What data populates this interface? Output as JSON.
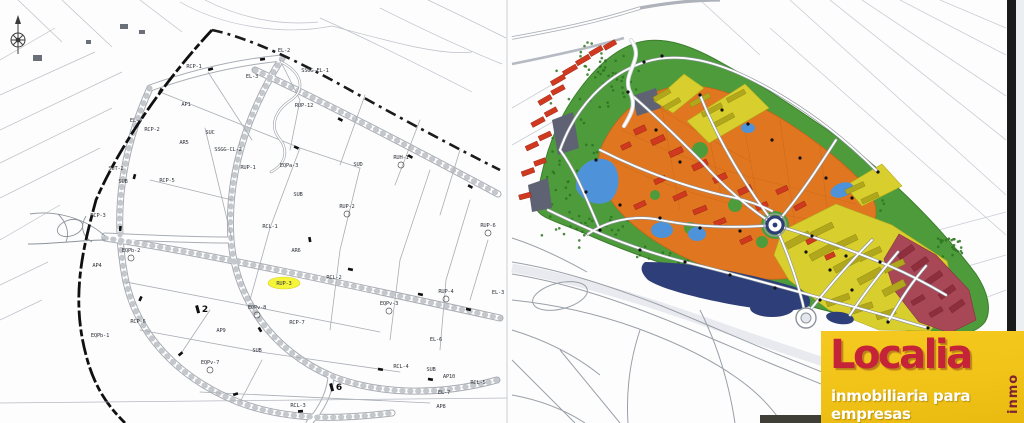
{
  "page": {
    "description": "Scanned urban-planning document: black & white cadastral zoning plan (left) and colored development masterplan (right) with Localia real-estate watermark",
    "width_px": 1024,
    "height_px": 423
  },
  "left_plan": {
    "title": "B/W cadastral zoning plan",
    "highlight_color": "#f4f43a",
    "highlighted_parcel": "RUP-3",
    "labels": [
      {
        "text": "RCP-1",
        "x": 194,
        "y": 68
      },
      {
        "text": "EL-2",
        "x": 284,
        "y": 52
      },
      {
        "text": "SSGG-EL-1",
        "x": 315,
        "y": 72
      },
      {
        "text": "EL-3",
        "x": 252,
        "y": 78
      },
      {
        "text": "AP1",
        "x": 186,
        "y": 106
      },
      {
        "text": "RUP-12",
        "x": 304,
        "y": 107
      },
      {
        "text": "EL-4",
        "x": 136,
        "y": 122
      },
      {
        "text": "RCP-2",
        "x": 152,
        "y": 131
      },
      {
        "text": "SUC",
        "x": 210,
        "y": 134
      },
      {
        "text": "AR5",
        "x": 184,
        "y": 144
      },
      {
        "text": "SSGG-CL-2",
        "x": 228,
        "y": 151
      },
      {
        "text": "SUT-2",
        "x": 116,
        "y": 170
      },
      {
        "text": "SUB",
        "x": 123,
        "y": 183
      },
      {
        "text": "RCP-5",
        "x": 167,
        "y": 182
      },
      {
        "text": "RUP-1",
        "x": 248,
        "y": 169
      },
      {
        "text": "EQPa-3",
        "x": 289,
        "y": 167
      },
      {
        "text": "SUD",
        "x": 358,
        "y": 166
      },
      {
        "text": "RUH-1",
        "x": 401,
        "y": 159,
        "circle": true
      },
      {
        "text": "SUB",
        "x": 298,
        "y": 196
      },
      {
        "text": "RUP-2",
        "x": 347,
        "y": 208,
        "circle": true
      },
      {
        "text": "RCP-3",
        "x": 98,
        "y": 217
      },
      {
        "text": "RCL-1",
        "x": 270,
        "y": 228
      },
      {
        "text": "RUP-6",
        "x": 488,
        "y": 227,
        "circle": true
      },
      {
        "text": "AR6",
        "x": 296,
        "y": 252
      },
      {
        "text": "EQPb-2",
        "x": 131,
        "y": 252,
        "circle": true
      },
      {
        "text": "AP4",
        "x": 97,
        "y": 267
      },
      {
        "text": "RUP-3",
        "x": 284,
        "y": 285,
        "hl": true
      },
      {
        "text": "RCL-2",
        "x": 334,
        "y": 279
      },
      {
        "text": "EL-3",
        "x": 498,
        "y": 294
      },
      {
        "text": "RUP-4",
        "x": 446,
        "y": 293,
        "circle": true
      },
      {
        "text": "EQPv-3",
        "x": 389,
        "y": 305,
        "circle": true
      },
      {
        "text": "EQPv-8",
        "x": 257,
        "y": 309,
        "circle": true
      },
      {
        "text": "RCP-7",
        "x": 297,
        "y": 324
      },
      {
        "text": "RCP-6",
        "x": 138,
        "y": 323
      },
      {
        "text": "AP9",
        "x": 221,
        "y": 332
      },
      {
        "text": "EQPb-1",
        "x": 100,
        "y": 337
      },
      {
        "text": "EL-6",
        "x": 436,
        "y": 341
      },
      {
        "text": "SUB",
        "x": 257,
        "y": 352
      },
      {
        "text": "EQPv-7",
        "x": 210,
        "y": 364,
        "circle": true
      },
      {
        "text": "RCL-4",
        "x": 401,
        "y": 368
      },
      {
        "text": "SUB",
        "x": 431,
        "y": 371
      },
      {
        "text": "AP10",
        "x": 449,
        "y": 378
      },
      {
        "text": "RCL-5",
        "x": 478,
        "y": 384
      },
      {
        "text": "EL-7",
        "x": 444,
        "y": 394
      },
      {
        "text": "RCL-3",
        "x": 298,
        "y": 407
      },
      {
        "text": "AP8",
        "x": 441,
        "y": 408
      }
    ],
    "road_markers": [
      {
        "text": "2",
        "x": 203,
        "y": 312
      },
      {
        "text": "6",
        "x": 337,
        "y": 390
      }
    ]
  },
  "right_plan": {
    "title": "Colored development masterplan",
    "colors": {
      "parkland_green": "#4e9b3c",
      "tree_green": "#2c741f",
      "residential_orange": "#e0761f",
      "building_red": "#d0391f",
      "mixed_yellow": "#d8cf2e",
      "terrace_yellow_dark": "#b1a71c",
      "strip_crimson": "#a84856",
      "pond_blue": "#4e93d9",
      "lake_navy": "#2e3e78",
      "parcel_gray": "#5f6272",
      "road_white": "#ffffff"
    }
  },
  "logo": {
    "brand": "Localia",
    "suffix": "inmo",
    "tagline": "inmobiliaria para empresas",
    "background": "#f1c319",
    "brand_color": "#c52337",
    "tagline_color": "#ffffff"
  }
}
